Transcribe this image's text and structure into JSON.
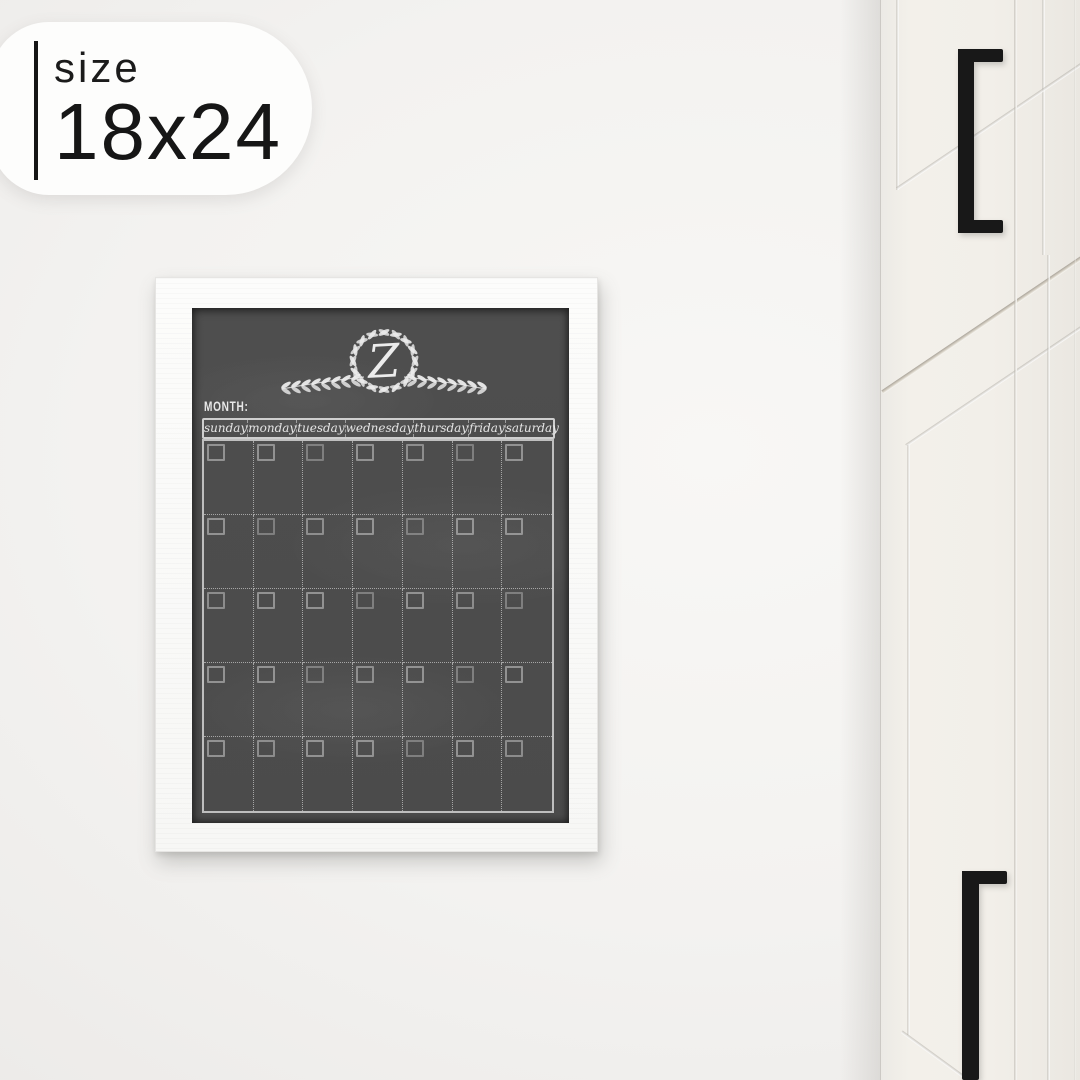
{
  "size_badge": {
    "label": "size",
    "value": "18x24"
  },
  "calendar": {
    "monogram": "Z",
    "month_label": "MONTH:",
    "day_headers": [
      "sunday",
      "monday",
      "tuesday",
      "wednesday",
      "thursday",
      "friday",
      "saturday"
    ],
    "weeks": 5
  },
  "icons": {
    "wreath": "laurel-wreath"
  },
  "colors": {
    "wall": "#f2f1ef",
    "badge_bg": "#fdfdfc",
    "badge_text": "#161616",
    "frame_white": "#fbfbfa",
    "chalkboard": "#4d4d4d",
    "chalk": "#e9e9e9",
    "cabinet_white": "#f1eee8",
    "cabinet_seam": "#c9c3b6",
    "handle_black": "#181818"
  }
}
